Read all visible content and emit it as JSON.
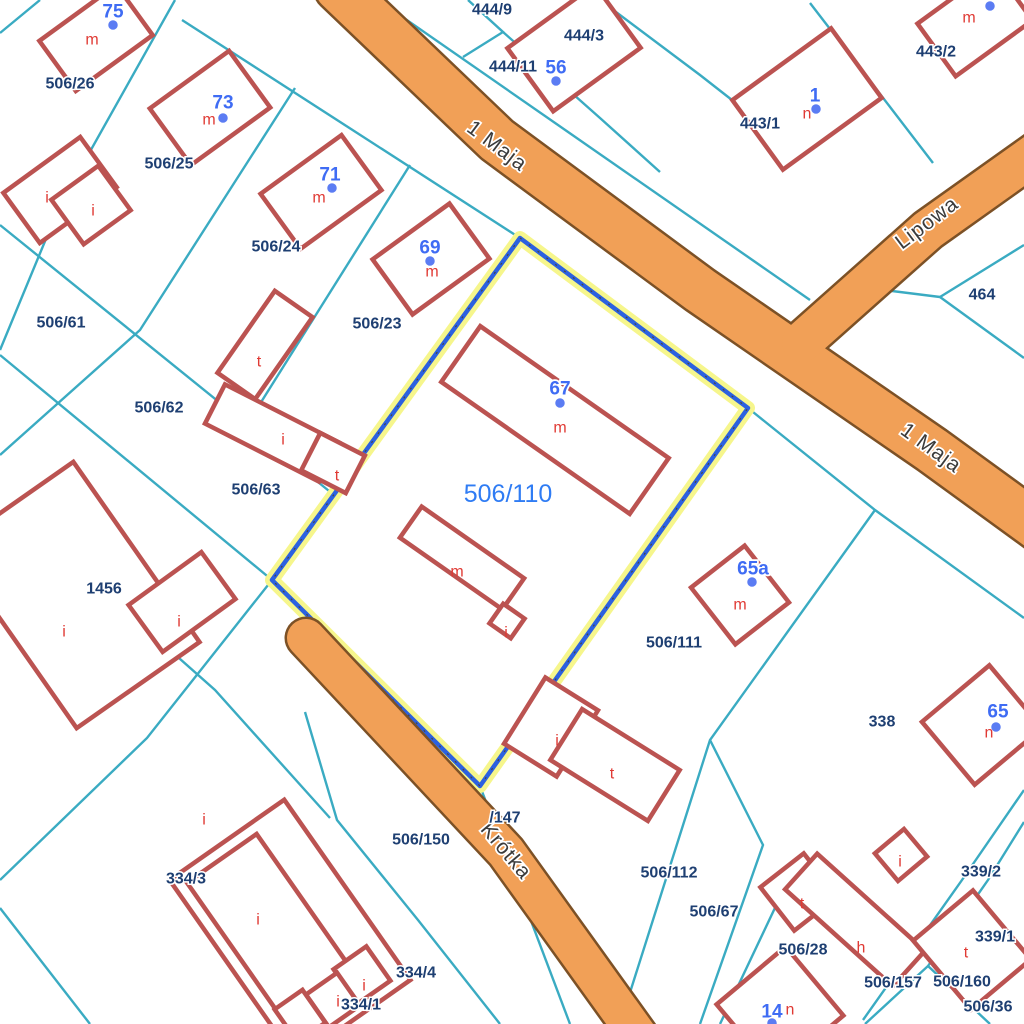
{
  "map": {
    "title": "cadastral-map-view",
    "colors": {
      "background": "#ffffff",
      "parcel_line": "#3aabc2",
      "parcel_label": "#1e3f72",
      "building_stroke": "#bb5351",
      "building_fill": "#ffffff",
      "building_letter": "#e03a34",
      "address_label": "#3f6cf4",
      "address_dot": "#5b7cf3",
      "road_fill": "#f1a057",
      "road_border": "#7c5126",
      "street_text": "#3b3b3b",
      "selection_halo": "#f6f68c",
      "selection_line": "#2c61e0",
      "selection_label": "#2f7cf4"
    },
    "selected_parcel": {
      "label": "506/110",
      "label_x": 508,
      "label_y": 494,
      "points": "520,238 748,408 480,786 272,580"
    },
    "roads": [
      {
        "name": "1 Maja",
        "pts": "338,-12 497,140 700,290 932,450 1064,546",
        "w": 46
      },
      {
        "name": "Lipowa",
        "pts": "802,342 928,230 1046,146",
        "w": 40
      },
      {
        "name": "Krótka",
        "pts": "306,638 506,852 644,1044",
        "w": 38
      }
    ],
    "street_labels": [
      {
        "t": "1 Maja",
        "x": 497,
        "y": 146,
        "rot": 37
      },
      {
        "t": "1 Maja",
        "x": 931,
        "y": 448,
        "rot": 36
      },
      {
        "t": "Lipowa",
        "x": 927,
        "y": 223,
        "rot": -37
      },
      {
        "t": "Krótka",
        "x": 506,
        "y": 851,
        "rot": 50
      }
    ],
    "parcel_lines": [
      "40,0 0,33",
      "175,0 60,205 0,350",
      "182,20 520,238",
      "295,88 140,330 0,455",
      "0,225 334,495",
      "410,165 258,407",
      "0,355 272,580",
      "272,580 147,738 0,880",
      "100,588 215,690 330,818",
      "378,0 810,300",
      "468,0 503,32 463,57",
      "503,32 600,118 660,172",
      "600,0 700,75 755,118",
      "810,3 877,90 933,163",
      "940,297 868,288",
      "940,297 1024,245",
      "940,297 1024,358",
      "748,408 875,510 1024,618",
      "875,510 710,740 620,1024",
      "710,740 763,845 700,1024",
      "800,855 720,1024",
      "480,786 570,1024",
      "305,712 337,820 418,920 500,1024",
      "1024,790 962,880 863,1020",
      "1024,822 988,880 928,966 865,1024",
      "928,966 990,1024",
      "0,908 90,1024"
    ],
    "buildings": [
      [
        96,
        38,
        95,
        62,
        -36
      ],
      [
        210,
        108,
        98,
        70,
        -36
      ],
      [
        321,
        192,
        100,
        68,
        -36
      ],
      [
        431,
        259,
        95,
        68,
        -36
      ],
      [
        574,
        48,
        108,
        78,
        -36
      ],
      [
        975,
        22,
        95,
        65,
        -36
      ],
      [
        807,
        99,
        122,
        86,
        -36
      ],
      [
        555,
        420,
        230,
        68,
        35
      ],
      [
        462,
        558,
        125,
        38,
        35
      ],
      [
        507,
        621,
        26,
        24,
        35
      ],
      [
        740,
        595,
        68,
        72,
        -38
      ],
      [
        982,
        725,
        88,
        82,
        -40
      ],
      [
        901,
        855,
        38,
        36,
        -40
      ],
      [
        60,
        190,
        95,
        62,
        -36
      ],
      [
        91,
        205,
        58,
        55,
        -36
      ],
      [
        265,
        345,
        46,
        100,
        35
      ],
      [
        272,
        433,
        128,
        44,
        27
      ],
      [
        333,
        463,
        50,
        42,
        27
      ],
      [
        75,
        595,
        150,
        220,
        -35
      ],
      [
        182,
        602,
        90,
        58,
        -36
      ],
      [
        551,
        727,
        62,
        78,
        32
      ],
      [
        615,
        765,
        115,
        60,
        32
      ],
      [
        799,
        892,
        55,
        55,
        -38
      ],
      [
        855,
        920,
        145,
        48,
        42
      ],
      [
        972,
        950,
        78,
        90,
        -40
      ],
      [
        780,
        1010,
        90,
        90,
        -40
      ],
      [
        290,
        930,
        220,
        140,
        55
      ],
      [
        272,
        930,
        175,
        85,
        55
      ],
      [
        362,
        975,
        42,
        40,
        55
      ],
      [
        333,
        1000,
        40,
        38,
        55
      ],
      [
        300,
        1016,
        40,
        34,
        55
      ]
    ],
    "parcel_labels": [
      {
        "t": "506/26",
        "x": 70,
        "y": 84
      },
      {
        "t": "506/25",
        "x": 169,
        "y": 164
      },
      {
        "t": "444/9",
        "x": 492,
        "y": 10
      },
      {
        "t": "444/3",
        "x": 584,
        "y": 36
      },
      {
        "t": "444/11",
        "x": 513,
        "y": 67
      },
      {
        "t": "443/2",
        "x": 936,
        "y": 52
      },
      {
        "t": "443/1",
        "x": 760,
        "y": 124
      },
      {
        "t": "464",
        "x": 982,
        "y": 295
      },
      {
        "t": "506/24",
        "x": 276,
        "y": 247
      },
      {
        "t": "506/23",
        "x": 377,
        "y": 324
      },
      {
        "t": "506/61",
        "x": 61,
        "y": 323
      },
      {
        "t": "506/62",
        "x": 159,
        "y": 408
      },
      {
        "t": "506/63",
        "x": 256,
        "y": 490
      },
      {
        "t": "1456",
        "x": 104,
        "y": 589
      },
      {
        "t": "506/111",
        "x": 674,
        "y": 643
      },
      {
        "t": "338",
        "x": 882,
        "y": 722
      },
      {
        "t": "339/2",
        "x": 981,
        "y": 872
      },
      {
        "t": "339/1",
        "x": 995,
        "y": 937
      },
      {
        "t": "506/150",
        "x": 421,
        "y": 840
      },
      {
        "t": "/147",
        "x": 505,
        "y": 818
      },
      {
        "t": "506/112",
        "x": 669,
        "y": 873
      },
      {
        "t": "506/67",
        "x": 714,
        "y": 912
      },
      {
        "t": "506/28",
        "x": 803,
        "y": 950
      },
      {
        "t": "506/157",
        "x": 893,
        "y": 983
      },
      {
        "t": "506/160",
        "x": 962,
        "y": 982
      },
      {
        "t": "506/36",
        "x": 988,
        "y": 1007
      },
      {
        "t": "334/3",
        "x": 186,
        "y": 879
      },
      {
        "t": "334/4",
        "x": 416,
        "y": 973
      },
      {
        "t": "334/1",
        "x": 361,
        "y": 1005
      }
    ],
    "address_points": [
      {
        "t": "75",
        "x": 113,
        "y": 12,
        "dx": 113,
        "dy": 25
      },
      {
        "t": "73",
        "x": 223,
        "y": 103,
        "dx": 223,
        "dy": 118
      },
      {
        "t": "56",
        "x": 556,
        "y": 68,
        "dx": 556,
        "dy": 81
      },
      {
        "t": "1",
        "x": 815,
        "y": 96,
        "dx": 816,
        "dy": 109
      },
      {
        "t": "71",
        "x": 330,
        "y": 175,
        "dx": 332,
        "dy": 188
      },
      {
        "t": "69",
        "x": 430,
        "y": 248,
        "dx": 430,
        "dy": 261
      },
      {
        "t": "67",
        "x": 560,
        "y": 389,
        "dx": 560,
        "dy": 403
      },
      {
        "t": "65a",
        "x": 753,
        "y": 569,
        "dx": 752,
        "dy": 582
      },
      {
        "t": "65",
        "x": 998,
        "y": 712,
        "dx": 996,
        "dy": 727
      },
      {
        "t": "14",
        "x": 772,
        "y": 1012,
        "dx": 772,
        "dy": 1023
      },
      {
        "t": "",
        "x": 990,
        "y": -10,
        "dx": 990,
        "dy": 6
      }
    ],
    "building_letters": [
      {
        "t": "m",
        "x": 92,
        "y": 40
      },
      {
        "t": "m",
        "x": 209,
        "y": 120
      },
      {
        "t": "m",
        "x": 319,
        "y": 198
      },
      {
        "t": "m",
        "x": 432,
        "y": 272
      },
      {
        "t": "m",
        "x": 969,
        "y": 18
      },
      {
        "t": "n",
        "x": 807,
        "y": 114
      },
      {
        "t": "m",
        "x": 560,
        "y": 428
      },
      {
        "t": "m",
        "x": 457,
        "y": 572
      },
      {
        "t": "m",
        "x": 740,
        "y": 605
      },
      {
        "t": "n",
        "x": 989,
        "y": 733
      },
      {
        "t": "n",
        "x": 790,
        "y": 1010
      },
      {
        "t": "i",
        "x": 47,
        "y": 198
      },
      {
        "t": "i",
        "x": 93,
        "y": 211
      },
      {
        "t": "t",
        "x": 259,
        "y": 362
      },
      {
        "t": "i",
        "x": 283,
        "y": 440
      },
      {
        "t": "t",
        "x": 337,
        "y": 476
      },
      {
        "t": "i",
        "x": 179,
        "y": 622
      },
      {
        "t": "i",
        "x": 64,
        "y": 632
      },
      {
        "t": "i",
        "x": 506,
        "y": 633
      },
      {
        "t": "i",
        "x": 557,
        "y": 741
      },
      {
        "t": "t",
        "x": 612,
        "y": 774
      },
      {
        "t": "t",
        "x": 802,
        "y": 904
      },
      {
        "t": "h",
        "x": 861,
        "y": 948
      },
      {
        "t": "t",
        "x": 966,
        "y": 953
      },
      {
        "t": "i",
        "x": 900,
        "y": 862
      },
      {
        "t": "i",
        "x": 204,
        "y": 820
      },
      {
        "t": "i",
        "x": 258,
        "y": 920
      },
      {
        "t": "i",
        "x": 364,
        "y": 986
      },
      {
        "t": "i",
        "x": 338,
        "y": 1002
      }
    ]
  }
}
